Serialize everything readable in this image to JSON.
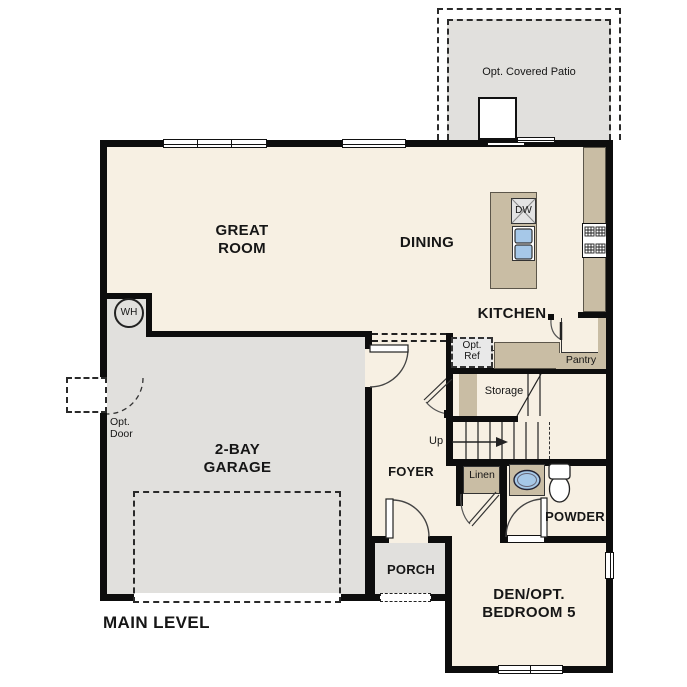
{
  "title": "MAIN LEVEL",
  "rooms": {
    "great_room": [
      "GREAT",
      "ROOM"
    ],
    "dining": "DINING",
    "kitchen": "KITCHEN",
    "garage": [
      "2-BAY",
      "GARAGE"
    ],
    "foyer": "FOYER",
    "porch": "PORCH",
    "powder": "POWDER",
    "den": [
      "DEN/OPT.",
      "BEDROOM 5"
    ]
  },
  "features": {
    "patio": "Opt. Covered Patio",
    "pantry": "Pantry",
    "storage": "Storage",
    "linen": "Linen",
    "up": "Up",
    "water_heater": "WH",
    "dishwasher": "DW",
    "opt_ref": [
      "Opt.",
      "Ref"
    ],
    "opt_door": [
      "Opt.",
      "Door"
    ]
  },
  "colors": {
    "wall": "#0d0d0d",
    "floor": "#f7f0e3",
    "concrete": "#e1e0dd",
    "counter": "#c9bda4",
    "fixture_blue": "#a6c8e8"
  }
}
